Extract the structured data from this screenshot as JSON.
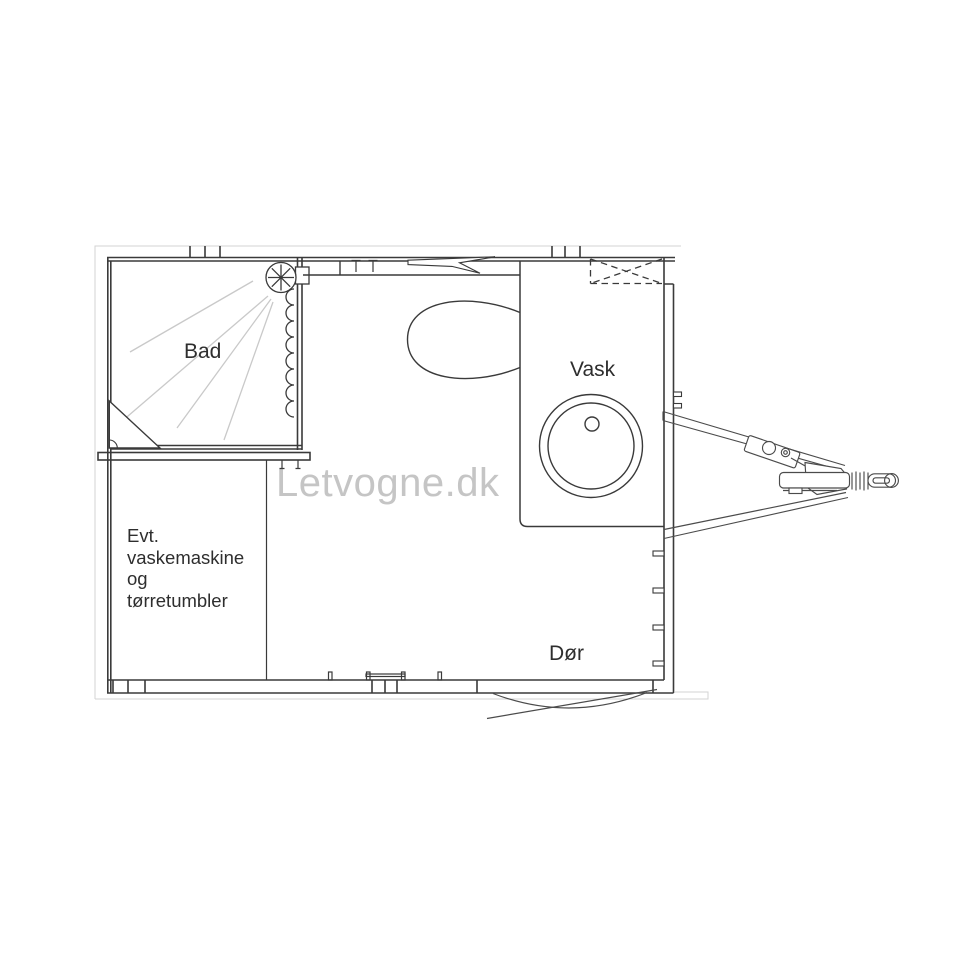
{
  "canvas": {
    "width": 960,
    "height": 960,
    "background": "#ffffff"
  },
  "watermark": {
    "text": "Letvogne.dk",
    "color": "#c5c5c5"
  },
  "rooms": {
    "shower_label": "Bad",
    "sink_label": "Vask",
    "door_label": "Dør",
    "washer_note_lines": [
      "Evt.",
      "vaskemaskine",
      "og",
      "tørretumbler"
    ]
  },
  "colors": {
    "wall_line": "#3a3a3a",
    "fixture_line": "#4b4b4b",
    "spray_line": "#c9c9c9",
    "frame_line": "#d3d3d3",
    "label_text": "#2e2e2e"
  },
  "fixtures": [
    "shower-head-icon",
    "shower-curtain-icon",
    "toilet-icon",
    "sink-icon",
    "faucet-icon",
    "skylight-vent-icon",
    "door-swing-icon",
    "coat-hooks-icon",
    "trailer-hitch-icon"
  ]
}
